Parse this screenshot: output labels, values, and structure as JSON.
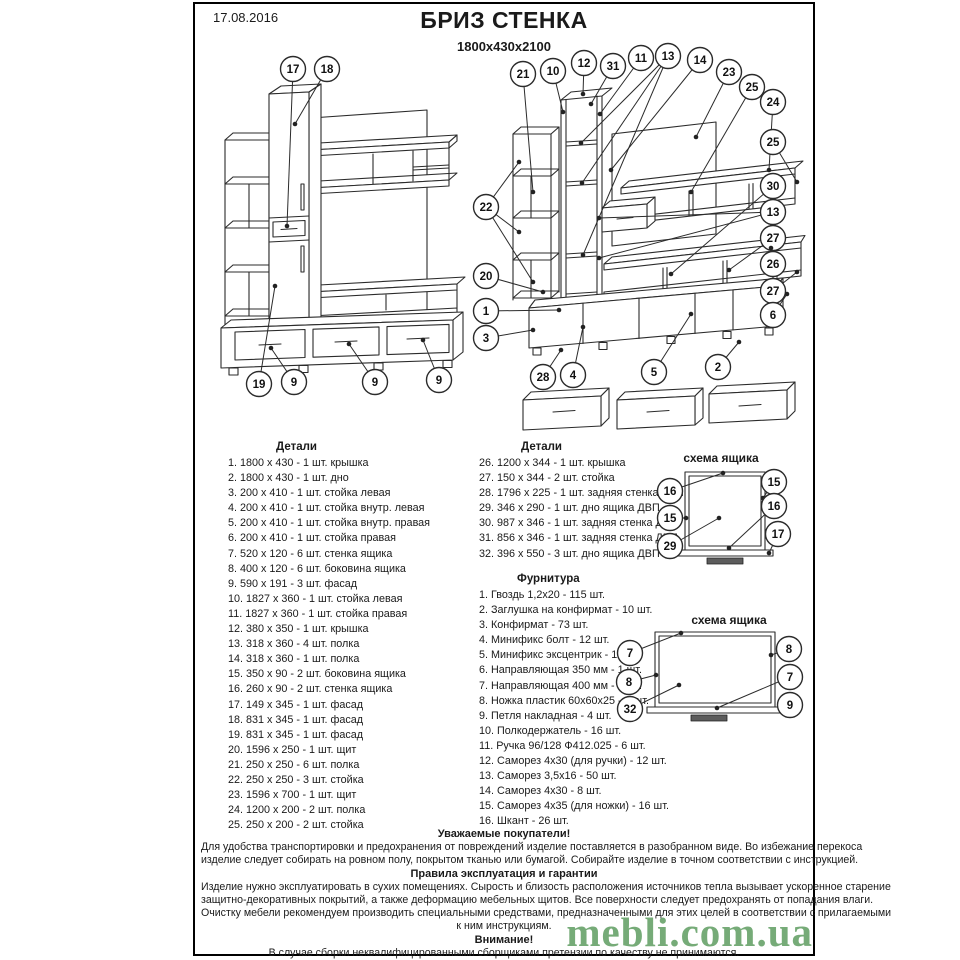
{
  "page": {
    "date": "17.08.2016",
    "title": "БРИЗ СТЕНКА",
    "subtitle": "1800x430x2100"
  },
  "parts_left": {
    "header": "Детали",
    "items": [
      "1. 1800 х 430 - 1 шт. крышка",
      "2. 1800 х 430 - 1 шт. дно",
      "3. 200 х 410 - 1 шт. стойка левая",
      "4. 200 х 410 - 1 шт. стойка внутр. левая",
      "5. 200 х 410 - 1 шт. стойка внутр. правая",
      "6. 200 х 410 - 1 шт. стойка правая",
      "7. 520 х 120 - 6 шт. стенка ящика",
      "8. 400 х 120 - 6 шт. боковина ящика",
      "9. 590 х 191 - 3 шт. фасад",
      "10. 1827 х 360 - 1 шт. стойка левая",
      "11. 1827 х 360 - 1 шт. стойка правая",
      "12. 380 х 350 - 1 шт. крышка",
      "13. 318 х 360 - 4 шт. полка",
      "14. 318 х 360 - 1 шт. полка",
      "15. 350 х 90 - 2 шт. боковина ящика",
      "16. 260 х 90 - 2 шт. стенка ящика",
      "17. 149 х 345 - 1 шт. фасад",
      "18. 831 х 345 - 1 шт. фасад",
      "19. 831 х 345 - 1 шт. фасад",
      "20. 1596 х 250 - 1 шт. щит",
      "21. 250 х 250 - 6 шт. полка",
      "22. 250 х 250 - 3 шт. стойка",
      "23. 1596 х 700 - 1 шт. щит",
      "24. 1200 х 200 - 2 шт. полка",
      "25. 250 х 200 - 2 шт. стойка"
    ]
  },
  "parts_right": {
    "header": "Детали",
    "items": [
      "26. 1200 х 344 - 1 шт. крышка",
      "27. 150 х 344 - 2 шт. стойка",
      "28. 1796 х 225 - 1 шт. задняя стенка ДВП",
      "29. 346 х 290 - 1 шт. дно ящика ДВП",
      "30. 987 х 346 - 1 шт. задняя стенка ДВП",
      "31. 856 х 346 - 1 шт. задняя стенка ДВП",
      "32. 396 х 550 - 3 шт. дно ящика ДВП"
    ]
  },
  "hardware": {
    "header": "Фурнитура",
    "items": [
      "1. Гвоздь 1,2х20 - 115 шт.",
      "2. Заглушка на конфирмат - 10 шт.",
      "3. Конфирмат - 73 шт.",
      "4. Минификс болт - 12 шт.",
      "5. Минификс эксцентрик - 12 шт.",
      "6. Направляющая 350 мм - 1 шт.",
      "7. Направляющая 400 мм - 3 шт.",
      "8. Ножка пластик 60х60х25 - 8 шт.",
      "9. Петля накладная - 4 шт.",
      "10. Полкодержатель - 16 шт.",
      "11. Ручка 96/128 Ф412.025 - 6 шт.",
      "12. Саморез 4х30 (для ручки) - 12 шт.",
      "13. Саморез 3,5х16 - 50 шт.",
      "14. Саморез 4х30 - 8 шт.",
      "15. Саморез 4х35 (для ножки) - 16 шт.",
      "16. Шкант - 26 шт."
    ]
  },
  "assembled_view": {
    "callouts": [
      {
        "n": "17",
        "x": 82,
        "y": 15,
        "t": [
          [
            76,
            172
          ]
        ]
      },
      {
        "n": "18",
        "x": 116,
        "y": 15,
        "t": [
          [
            84,
            70
          ]
        ]
      },
      {
        "n": "19",
        "x": 48,
        "y": 330,
        "t": [
          [
            64,
            232
          ]
        ]
      },
      {
        "n": "9",
        "x": 83,
        "y": 328,
        "t": [
          [
            60,
            294
          ]
        ]
      },
      {
        "n": "9",
        "x": 164,
        "y": 328,
        "t": [
          [
            138,
            290
          ]
        ]
      },
      {
        "n": "9",
        "x": 228,
        "y": 326,
        "t": [
          [
            212,
            286
          ]
        ]
      }
    ]
  },
  "exploded_view": {
    "callouts": [
      {
        "n": "21",
        "x": 52,
        "y": 32,
        "t": [
          [
            62,
            150
          ]
        ]
      },
      {
        "n": "10",
        "x": 82,
        "y": 29,
        "t": [
          [
            92,
            70
          ]
        ]
      },
      {
        "n": "12",
        "x": 113,
        "y": 21,
        "t": [
          [
            112,
            52
          ]
        ]
      },
      {
        "n": "31",
        "x": 142,
        "y": 24,
        "t": [
          [
            120,
            62
          ]
        ]
      },
      {
        "n": "11",
        "x": 170,
        "y": 16,
        "t": [
          [
            129,
            72
          ]
        ]
      },
      {
        "n": "13",
        "x": 197,
        "y": 14,
        "t": [
          [
            110,
            101
          ],
          [
            111,
            141
          ],
          [
            112,
            213
          ]
        ]
      },
      {
        "n": "14",
        "x": 229,
        "y": 18,
        "t": [
          [
            140,
            128
          ]
        ]
      },
      {
        "n": "23",
        "x": 258,
        "y": 30,
        "t": [
          [
            225,
            95
          ]
        ]
      },
      {
        "n": "25",
        "x": 281,
        "y": 45,
        "t": [
          [
            220,
            150
          ]
        ]
      },
      {
        "n": "24",
        "x": 302,
        "y": 60,
        "t": [
          [
            298,
            128
          ]
        ]
      },
      {
        "n": "25",
        "x": 302,
        "y": 100,
        "t": [
          [
            326,
            140
          ]
        ]
      },
      {
        "n": "30",
        "x": 302,
        "y": 144,
        "t": [
          [
            200,
            232
          ]
        ]
      },
      {
        "n": "13",
        "x": 302,
        "y": 170,
        "t": [
          [
            128,
            176
          ],
          [
            128,
            216
          ]
        ]
      },
      {
        "n": "27",
        "x": 302,
        "y": 196,
        "t": [
          [
            258,
            228
          ]
        ]
      },
      {
        "n": "26",
        "x": 302,
        "y": 222,
        "t": [
          [
            300,
            206
          ]
        ]
      },
      {
        "n": "27",
        "x": 302,
        "y": 249,
        "t": [
          [
            326,
            230
          ]
        ]
      },
      {
        "n": "6",
        "x": 302,
        "y": 273,
        "t": [
          [
            316,
            252
          ]
        ]
      },
      {
        "n": "22",
        "x": 15,
        "y": 165,
        "t": [
          [
            48,
            120
          ],
          [
            48,
            190
          ],
          [
            62,
            240
          ]
        ]
      },
      {
        "n": "20",
        "x": 15,
        "y": 234,
        "t": [
          [
            72,
            250
          ]
        ]
      },
      {
        "n": "1",
        "x": 15,
        "y": 269,
        "t": [
          [
            88,
            268
          ]
        ]
      },
      {
        "n": "3",
        "x": 15,
        "y": 296,
        "t": [
          [
            62,
            288
          ]
        ]
      },
      {
        "n": "28",
        "x": 72,
        "y": 335,
        "t": [
          [
            90,
            308
          ]
        ]
      },
      {
        "n": "4",
        "x": 102,
        "y": 333,
        "t": [
          [
            112,
            285
          ]
        ]
      },
      {
        "n": "5",
        "x": 183,
        "y": 330,
        "t": [
          [
            220,
            272
          ]
        ]
      },
      {
        "n": "2",
        "x": 247,
        "y": 325,
        "t": [
          [
            268,
            300
          ]
        ]
      }
    ]
  },
  "scheme1": {
    "title": "схема ящика",
    "callouts": [
      {
        "n": "16",
        "x": 25,
        "y": 23,
        "t": [
          [
            78,
            5
          ]
        ]
      },
      {
        "n": "15",
        "x": 129,
        "y": 14,
        "t": [
          [
            118,
            30
          ]
        ]
      },
      {
        "n": "15",
        "x": 25,
        "y": 50,
        "t": [
          [
            41,
            50
          ]
        ]
      },
      {
        "n": "16",
        "x": 129,
        "y": 38,
        "t": [
          [
            84,
            80
          ]
        ]
      },
      {
        "n": "29",
        "x": 25,
        "y": 78,
        "t": [
          [
            74,
            50
          ]
        ]
      },
      {
        "n": "17",
        "x": 133,
        "y": 66,
        "t": [
          [
            124,
            85
          ]
        ]
      }
    ]
  },
  "scheme2": {
    "title": "схема ящика",
    "callouts": [
      {
        "n": "7",
        "x": 17,
        "y": 26,
        "t": [
          [
            68,
            6
          ]
        ]
      },
      {
        "n": "8",
        "x": 16,
        "y": 55,
        "t": [
          [
            43,
            48
          ]
        ]
      },
      {
        "n": "32",
        "x": 17,
        "y": 82,
        "t": [
          [
            66,
            58
          ]
        ]
      },
      {
        "n": "8",
        "x": 176,
        "y": 22,
        "t": [
          [
            158,
            28
          ]
        ]
      },
      {
        "n": "7",
        "x": 177,
        "y": 50,
        "t": [
          [
            104,
            81
          ]
        ]
      },
      {
        "n": "9",
        "x": 177,
        "y": 78,
        "t": [
          [
            168,
            83
          ]
        ]
      }
    ]
  },
  "footer": {
    "lines": [
      {
        "text": "Уважаемые покупатели!",
        "bold": true
      },
      {
        "text": "Для удобства транспортировки и предохранения от повреждений изделие поставляется в разобранном виде. Во избежание перекоса",
        "bold": false
      },
      {
        "text": "изделие следует собирать на ровном полу, покрытом тканью или бумагой. Собирайте изделие в точном соответствии с инструкцией.",
        "bold": false
      },
      {
        "text": "Правила эксплуатация и гарантии",
        "bold": true
      },
      {
        "text": "Изделие нужно эксплуатировать в сухих помещениях. Сырость и близость расположения источников тепла вызывает ускоренное старение",
        "bold": false
      },
      {
        "text": "защитно-декоративных покрытий, а также деформацию мебельных щитов. Все поверхности следует предохранять от попадания влаги.",
        "bold": false
      },
      {
        "text": "Очистку мебели рекомендуем производить специальными средствами, предназначенными для этих целей в соответствии с прилагаемыми",
        "bold": false
      },
      {
        "text": "к ним инструкциям.",
        "bold": false
      },
      {
        "text": "Внимание!",
        "bold": true
      },
      {
        "text": "В случае сборки неквалифицированными сборщиками претензии по качеству не принимаются.",
        "bold": false
      }
    ]
  },
  "watermark": {
    "text": "mebli.com.ua",
    "color": "#64a066"
  }
}
